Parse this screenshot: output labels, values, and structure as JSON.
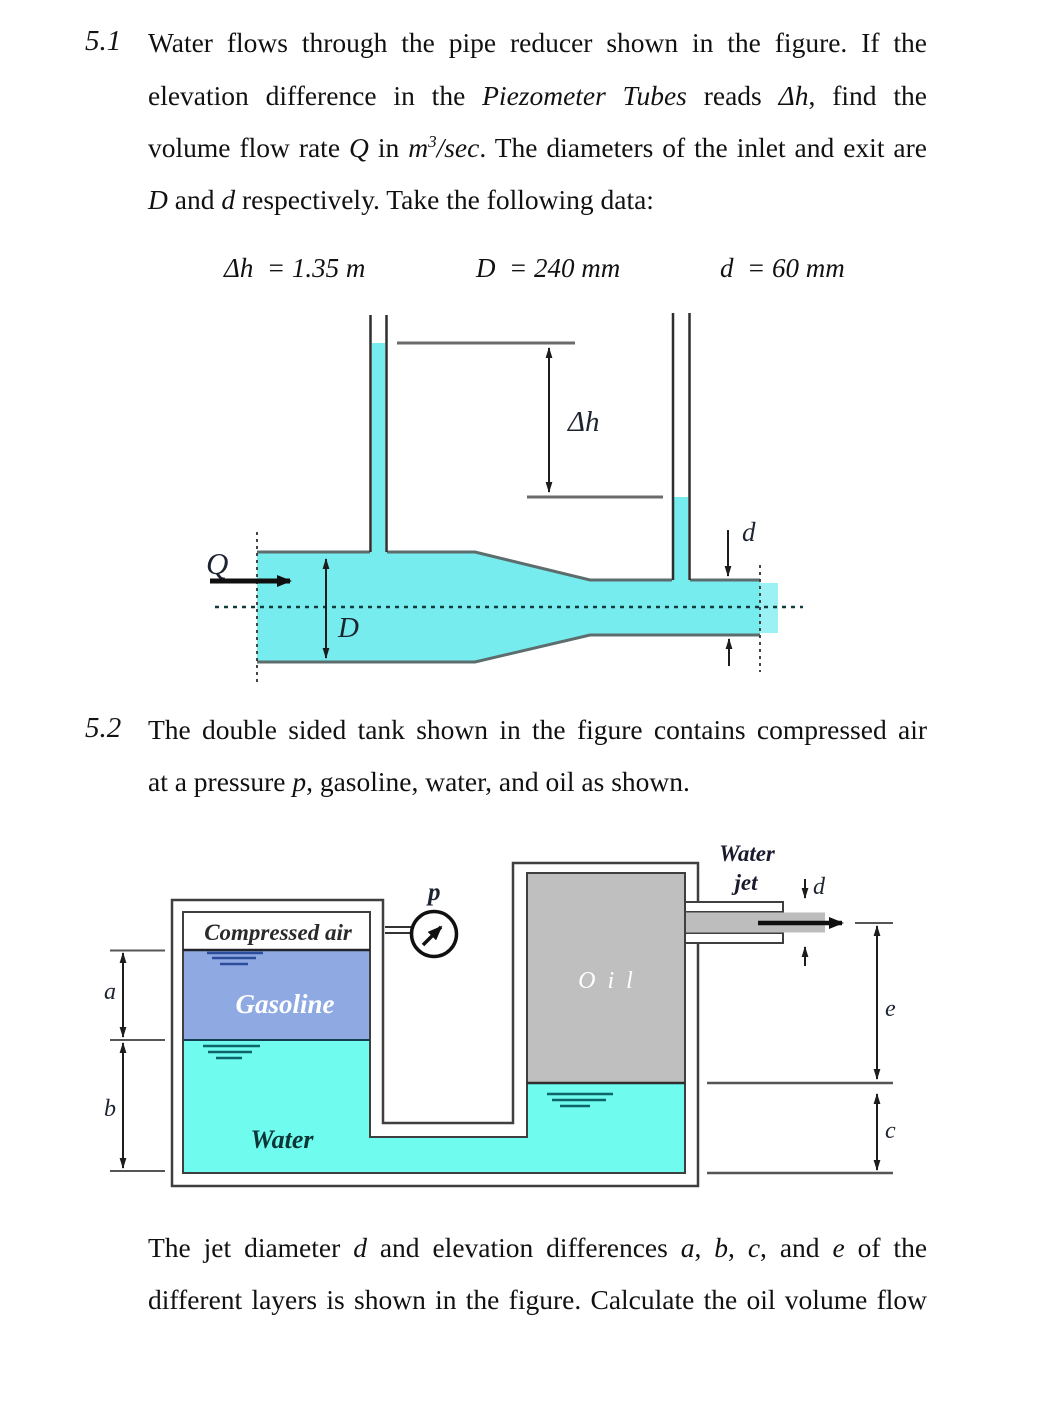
{
  "colors": {
    "water_fig1": "#76ECEF",
    "jet_fig1": "#9BF2F4",
    "water_fig2": "#6FFBEE",
    "gasoline": "#8FA9E2",
    "oil": "#BFBFBF",
    "pipe_interior": "#BDBDBD"
  },
  "problem51": {
    "number": "5.1",
    "line1": "Water flows through the pipe reducer shown in the figure. If the",
    "line2_a": "elevation difference in the ",
    "line2_b": "Piezometer Tubes",
    "line2_c": " reads ",
    "line2_d": "Δh",
    "line2_e": ", find the",
    "line3_a": "volume flow rate ",
    "line3_b": "Q",
    "line3_c": " in ",
    "line3_d": "m",
    "line3_e": "3",
    "line3_f": "/sec",
    "line3_g": ". The diameters of the inlet and exit are",
    "line4_a": "D",
    "line4_b": " and ",
    "line4_c": "d",
    "line4_d": " respectively. Take the following data:",
    "given": {
      "delta_h": "Δh  = 1.35 m",
      "D": "D  = 240 mm",
      "d": "d  = 60 mm"
    }
  },
  "figure51": {
    "labels": {
      "q": "Q",
      "D": "D",
      "d": "d",
      "delta_h": "Δh"
    }
  },
  "problem52": {
    "number": "5.2",
    "line1": "The double sided tank shown in the figure contains compressed air",
    "line2_a": "at a pressure ",
    "line2_b": "p",
    "line2_c": ", gasoline, water, and oil as shown."
  },
  "figure52": {
    "labels": {
      "compressed_air": "Compressed air",
      "gasoline": "Gasoline",
      "water": "Water",
      "oil": "O i l",
      "water_jet_line1": "Water",
      "water_jet_line2": "jet",
      "p": "p",
      "a": "a",
      "b": "b",
      "c": "c",
      "d": "d",
      "e": "e"
    }
  },
  "closing": {
    "line1_a": "The jet diameter ",
    "line1_b": "d",
    "line1_c": " and elevation differences ",
    "line1_d": "a",
    "line1_e": ", ",
    "line1_f": "b",
    "line1_g": ", ",
    "line1_h": "c",
    "line1_i": ", and ",
    "line1_j": "e",
    "line1_k": " of the",
    "line2": "different layers is shown in the figure. Calculate the oil volume flow"
  }
}
